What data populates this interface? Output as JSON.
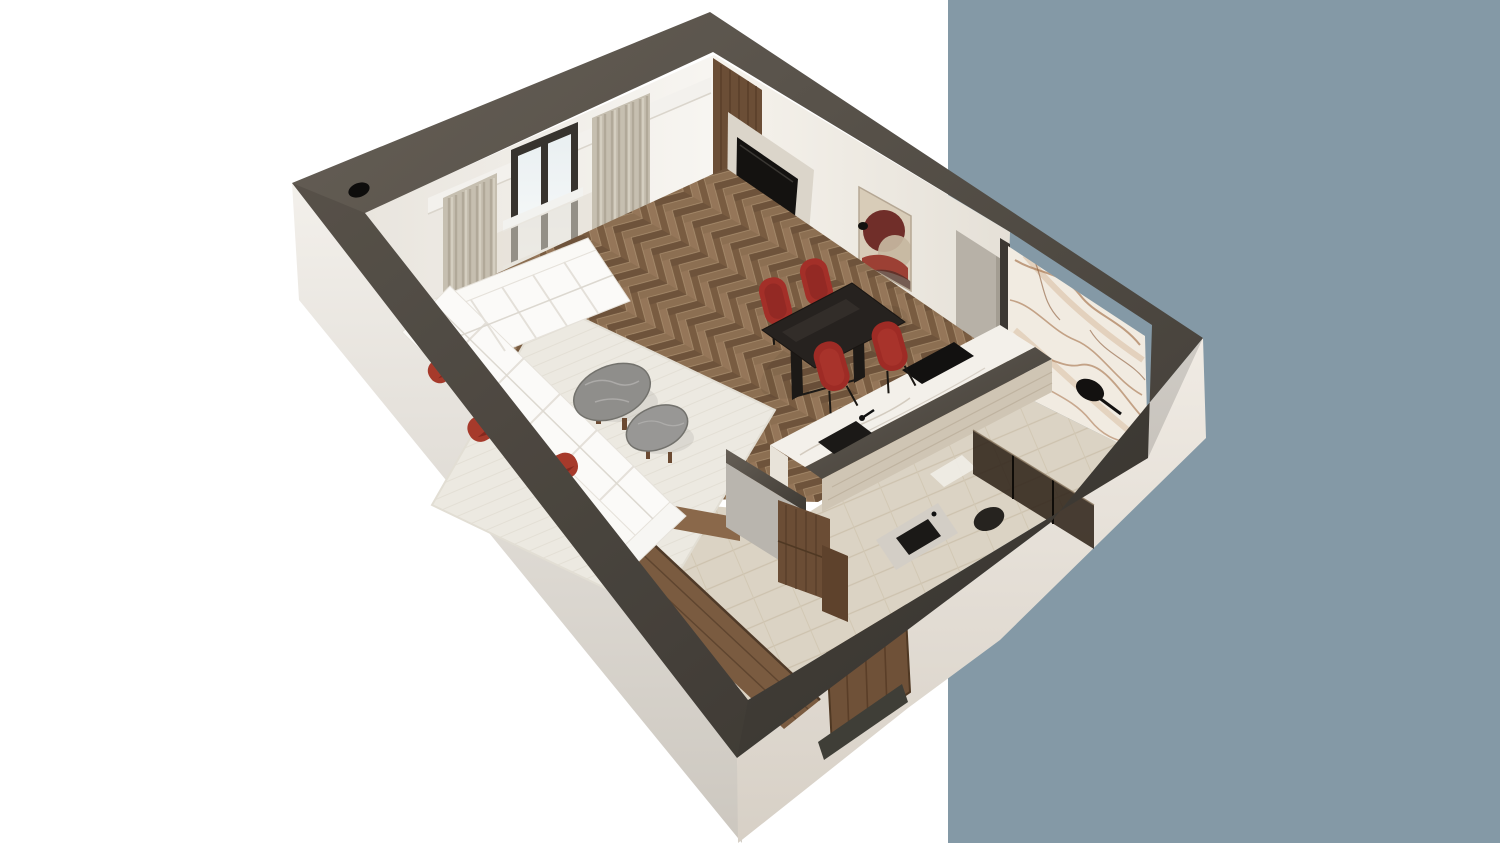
{
  "scene": {
    "type": "3d-floorplan-render",
    "view": "isometric-cutaway-apartment",
    "rooms": [
      "living-room",
      "kitchen",
      "bathroom",
      "hallway"
    ],
    "objects": [
      "blue-accent-panel",
      "apartment-shell",
      "window",
      "curtains",
      "sheer-curtain",
      "radiator",
      "sectional-sofa",
      "throw-pillow-1",
      "throw-pillow-2",
      "throw-pillow-3",
      "coffee-table-large",
      "coffee-table-small",
      "area-rug",
      "herringbone-parquet",
      "tv-wood-panel",
      "tv-screen",
      "media-console",
      "wall-artwork",
      "dining-table",
      "dining-chair-1",
      "dining-chair-2",
      "dining-chair-3",
      "dining-chair-4",
      "kitchen-counter",
      "cooktop",
      "kitchen-sink",
      "faucet",
      "marble-bathroom-wall",
      "shower-head",
      "shower-glass",
      "toilet",
      "vanity-basin",
      "bath-mat",
      "hallway-travertine-floor",
      "wardrobe",
      "interior-door",
      "entry-door",
      "door-threshold",
      "ceiling-spotlight",
      "ceiling-spotlight-small",
      "partition-wall",
      "pilaster"
    ]
  },
  "colors": {
    "background": "#FFFFFF",
    "panel_blue": "#8499A6",
    "wall_top_dark": "#55504A",
    "exterior_light": "#F0EDE8",
    "interior_wall": "#F6F4F0",
    "parquet_base": "#AE9373",
    "parquet_light": "#98795C",
    "parquet_dark": "#7A5D42",
    "travertine": "#DBD3C4",
    "travertine_face": "#CFC5B4",
    "rug_cream": "#ECE9E1",
    "sofa_white": "#FAF9F6",
    "pillow_red": "#A63A2B",
    "chair_red": "#A32F28",
    "dining_table_dark": "#26221F",
    "coffee_table_gray": "#8F8E8B",
    "wood_walnut": "#6B4E36",
    "wood_wardrobe": "#7A5B40",
    "door_wood": "#6F5138",
    "console_beige": "#C8C0B1",
    "tv_frame": "#DBD5CA",
    "tv_screen": "#141210",
    "curtain_beige": "#C6BFB0",
    "sheer_white": "#E2DDD2",
    "window_frame": "#37332E",
    "marble_white": "#F1EBE1",
    "marble_vein": "#A5714A",
    "counter_marble": "#F3F0EA",
    "appliance_black": "#121110",
    "shower_glass": "#2A1E14",
    "artwork_bg": "#D8CCB8",
    "artwork_maroon": "#702E29",
    "artwork_beige": "#C7B9A1",
    "artwork_red": "#9C4034",
    "pilaster_gray": "#B7B1A7",
    "partition_face": "#B9B5AE"
  }
}
